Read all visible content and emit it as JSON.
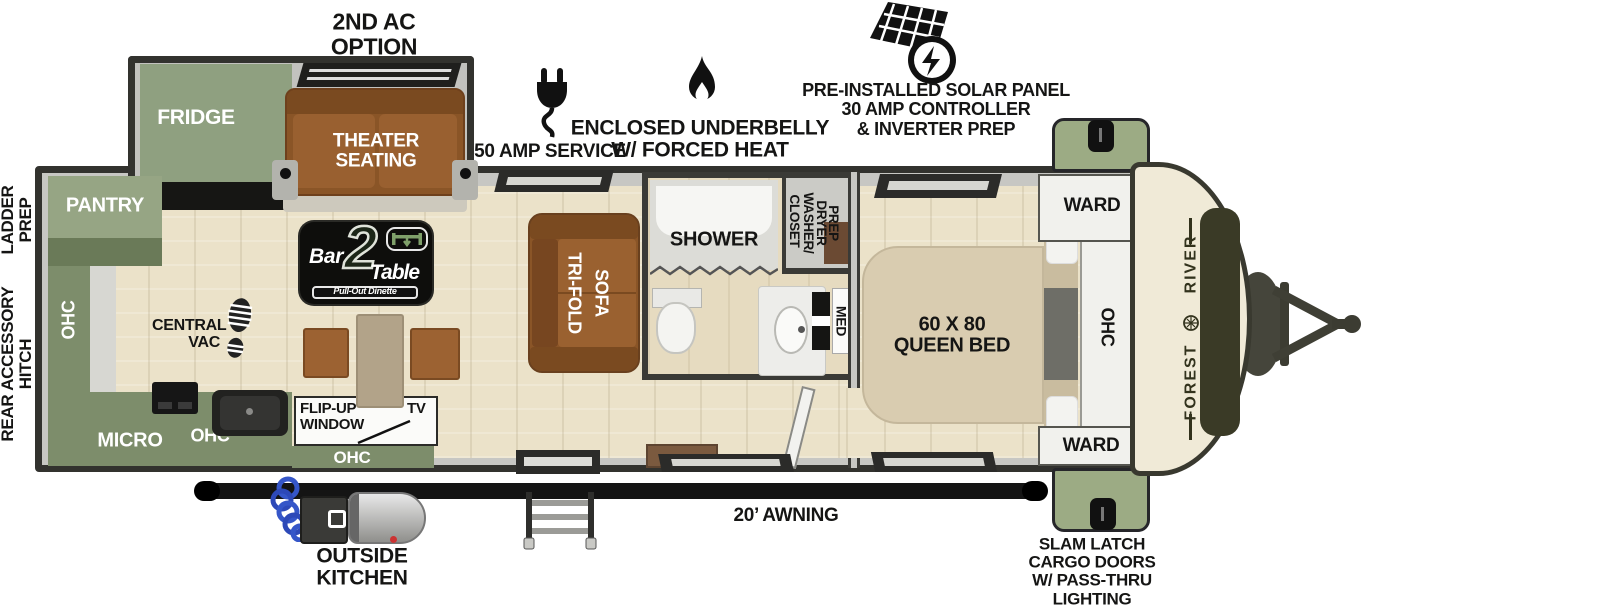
{
  "callouts": {
    "second_ac": "2ND AC\nOPTION",
    "amp_service": "50 AMP SERVICE",
    "underbelly": "ENCLOSED UNDERBELLY\nW/ FORCED HEAT",
    "solar": "PRE-INSTALLED SOLAR PANEL\n30 AMP CONTROLLER\n& INVERTER PREP",
    "ladder_prep": "LADDER\nPREP",
    "rear_accessory_hitch": "REAR ACCESSORY\nHITCH",
    "outside_kitchen": "OUTSIDE\nKITCHEN",
    "awning": "20’ AWNING",
    "cargo_doors": "SLAM LATCH\nCARGO DOORS\nW/ PASS-THRU\nLIGHTING"
  },
  "rooms": {
    "fridge": "FRIDGE",
    "theater_seating": "THEATER\nSEATING",
    "pantry": "PANTRY",
    "ohc_rear_wall": "OHC",
    "central_vac": "CENTRAL\nVAC",
    "micro": "MICRO",
    "ohc_kitchen": "OHC",
    "ohc_galley": "OHC",
    "flip_up_window": "FLIP-UP\nWINDOW",
    "tv": "TV",
    "trifold_sofa": [
      "TRI-FOLD",
      "SOFA"
    ],
    "shower": "SHOWER",
    "closet_lines": [
      "CLOSET",
      "WASHER/",
      "DRYER",
      "PREP"
    ],
    "med": "MED",
    "queen_bed": "60 X 80\nQUEEN BED",
    "ward_front_top": "WARD",
    "ohc_front": "OHC",
    "ward_front_bottom": "WARD"
  },
  "brand": {
    "first": "FOREST",
    "second": "RIVER"
  },
  "logo": {
    "bar": "Bar",
    "two": "2",
    "table": "Table",
    "subtitle": "Pull-Out Dinette"
  },
  "colors": {
    "cabinet_green": "#7d8d6b",
    "pantry_green": "#96a584",
    "cargo_door_green": "#9cab84",
    "sofa_brown": "#8a5527",
    "floor_tan": "#ebe2c9",
    "front_cap_cream": "#f0ead7",
    "wall_gray": "#c7c7c3"
  }
}
